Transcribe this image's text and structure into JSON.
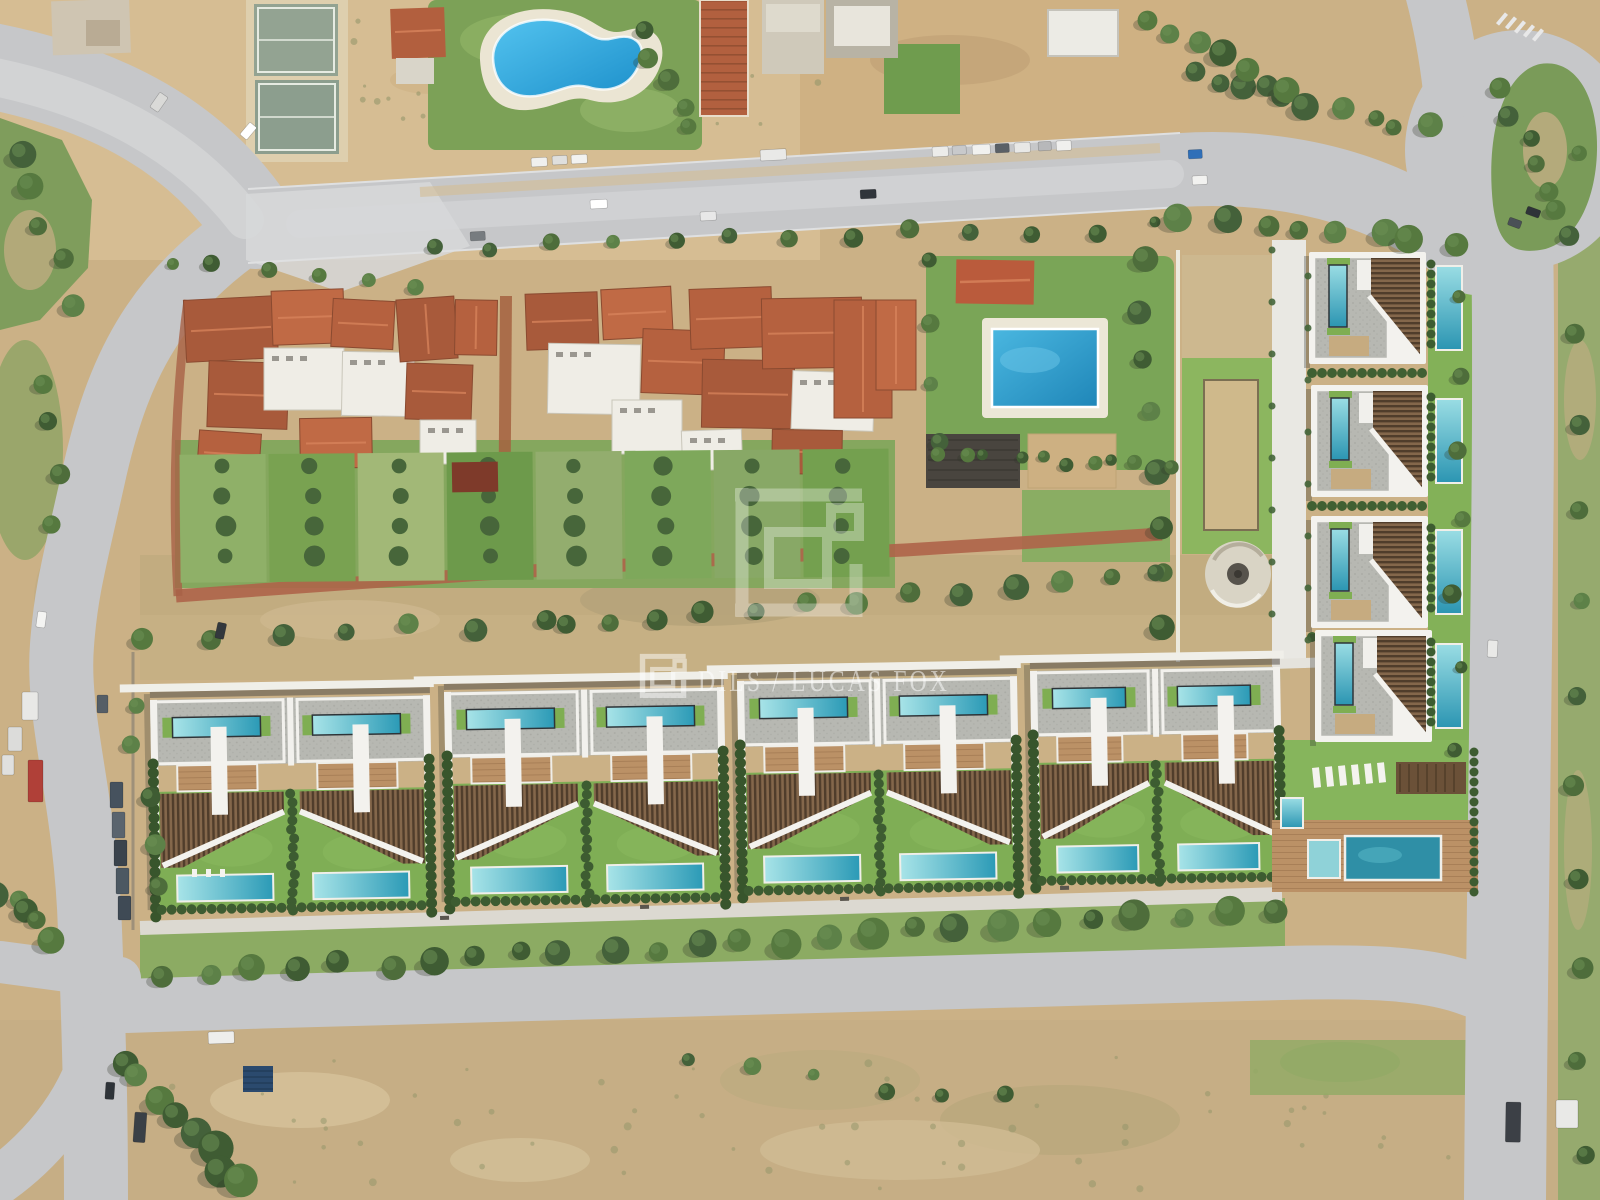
{
  "meta": {
    "title": "Aerial drone photograph of a modern villa development beside an established Mediterranean neighbourhood",
    "image_type": "aerial-photograph",
    "view": "top-down"
  },
  "watermark": {
    "logo_icon": "dils-bracket-logo",
    "text": "DILS / LUCAS FOX",
    "color": "#ffffff",
    "text_opacity": 0.52,
    "big_logo_opacity": 0.32,
    "small_logo_opacity": 0.5
  },
  "palette": {
    "dirt": "#cbb186",
    "dirt_light": "#d6bd93",
    "dirt_dark": "#b5a176",
    "road": "#c6c7c9",
    "road_light": "#d4d5d6",
    "concrete": "#d8d9da",
    "grass": "#7da45a",
    "grass_bright": "#7fae55",
    "grass_pale": "#9ab173",
    "tree": "#4e6d3b",
    "hedge": "#3d5c31",
    "terracotta": "#b5613f",
    "white_roof": "#efede6",
    "gray_roof": "#b6b7b1",
    "wood_deck": "#c9ad83",
    "louver": "#84674b",
    "louver_dark": "#503d2b",
    "pool_blue": "#2fa3d8",
    "pool_teal": "#2b9ab6",
    "pool_teal_light": "#a8e4e8",
    "brick_path": "#ae6449",
    "white_wall": "#f3f2ee"
  },
  "development": {
    "bottom_blocks": [
      {
        "x": 150,
        "y": 700,
        "w": 280
      },
      {
        "x": 444,
        "y": 692,
        "w": 280
      },
      {
        "x": 737,
        "y": 681,
        "w": 280
      },
      {
        "x": 1030,
        "y": 671,
        "w": 250
      }
    ],
    "right_villas": [
      {
        "x": 1309,
        "y": 252
      },
      {
        "x": 1311,
        "y": 385
      },
      {
        "x": 1311,
        "y": 516
      },
      {
        "x": 1315,
        "y": 630
      }
    ],
    "villa_size": {
      "w": 117,
      "h": 112
    },
    "ground_pool_x": 1436,
    "pool_loungers": [
      {
        "x": 192,
        "y": 869
      },
      {
        "x": 206,
        "y": 869
      },
      {
        "x": 220,
        "y": 869
      }
    ],
    "amenity_loungers": [
      {
        "x": 1312,
        "y": 768
      },
      {
        "x": 1325,
        "y": 767
      },
      {
        "x": 1338,
        "y": 766
      },
      {
        "x": 1351,
        "y": 765
      },
      {
        "x": 1364,
        "y": 764
      },
      {
        "x": 1377,
        "y": 763
      }
    ],
    "bench_positions": [
      [
        440,
        916
      ],
      [
        640,
        905
      ],
      [
        840,
        897
      ],
      [
        1060,
        886
      ]
    ]
  },
  "cluster_roofs": [
    [
      185,
      298,
      92,
      62,
      -3,
      "t"
    ],
    [
      208,
      362,
      80,
      66,
      2,
      "t"
    ],
    [
      272,
      290,
      72,
      54,
      -2,
      "t"
    ],
    [
      264,
      348,
      80,
      62,
      0,
      "w"
    ],
    [
      332,
      300,
      62,
      48,
      3,
      "t"
    ],
    [
      342,
      352,
      72,
      64,
      1,
      "w"
    ],
    [
      300,
      418,
      72,
      50,
      -1,
      "t"
    ],
    [
      198,
      432,
      62,
      44,
      4,
      "t"
    ],
    [
      398,
      298,
      58,
      62,
      -4,
      "t"
    ],
    [
      406,
      364,
      66,
      56,
      2,
      "t"
    ],
    [
      420,
      420,
      56,
      44,
      0,
      "w"
    ],
    [
      455,
      300,
      42,
      55,
      1,
      "t"
    ],
    [
      526,
      293,
      72,
      56,
      -2,
      "t"
    ],
    [
      548,
      344,
      92,
      70,
      1,
      "w"
    ],
    [
      602,
      288,
      70,
      50,
      -3,
      "t"
    ],
    [
      642,
      330,
      82,
      64,
      2,
      "t"
    ],
    [
      612,
      400,
      70,
      54,
      0,
      "w"
    ],
    [
      690,
      288,
      82,
      60,
      -2,
      "t"
    ],
    [
      702,
      360,
      92,
      68,
      1,
      "t"
    ],
    [
      762,
      298,
      100,
      70,
      -1,
      "t"
    ],
    [
      792,
      372,
      82,
      58,
      2,
      "w"
    ],
    [
      834,
      300,
      58,
      118,
      0,
      "t"
    ],
    [
      772,
      430,
      70,
      44,
      1,
      "t"
    ],
    [
      682,
      430,
      60,
      40,
      -2,
      "w"
    ],
    [
      876,
      300,
      40,
      90,
      0,
      "t"
    ]
  ],
  "garden_plots": {
    "x1": 180,
    "w": 86,
    "gap": 3,
    "y": 452,
    "h": 128,
    "count": 8,
    "colors": [
      "#8fb068",
      "#79a251",
      "#a2b877",
      "#6d9a4b",
      "#93ad6e",
      "#7ea85b",
      "#88a866",
      "#74a04f"
    ],
    "tree_columns": [
      224,
      312,
      400,
      488,
      576,
      664,
      752,
      840
    ]
  },
  "tree_rows": [
    [
      430,
      252,
      1150,
      226,
      13,
      5,
      10
    ],
    [
      1185,
      218,
      1455,
      240,
      8,
      9,
      15
    ],
    [
      1190,
      70,
      1430,
      130,
      9,
      8,
      14
    ],
    [
      150,
      640,
      545,
      622,
      7,
      6,
      12
    ],
    [
      560,
      622,
      1160,
      574,
      13,
      7,
      14
    ],
    [
      168,
      975,
      1268,
      912,
      26,
      9,
      16
    ],
    [
      690,
      1065,
      1010,
      1100,
      6,
      5,
      9
    ],
    [
      1452,
      300,
      1462,
      745,
      7,
      6,
      10
    ],
    [
      1572,
      150,
      1578,
      1150,
      12,
      7,
      12
    ],
    [
      638,
      35,
      692,
      128,
      5,
      7,
      11
    ],
    [
      1155,
      18,
      1310,
      105,
      8,
      9,
      15
    ],
    [
      15,
      150,
      75,
      300,
      5,
      9,
      14
    ],
    [
      120,
      1060,
      245,
      1185,
      8,
      11,
      18
    ],
    [
      42,
      380,
      58,
      520,
      4,
      8,
      12
    ],
    [
      165,
      262,
      420,
      285,
      6,
      5,
      9
    ],
    [
      935,
      262,
      940,
      445,
      4,
      7,
      10
    ],
    [
      1145,
      255,
      1160,
      630,
      8,
      8,
      13
    ],
    [
      133,
      700,
      152,
      888,
      5,
      7,
      11
    ],
    [
      940,
      458,
      1165,
      462,
      10,
      5,
      8
    ],
    [
      0,
      895,
      55,
      935,
      5,
      9,
      14
    ],
    [
      1500,
      90,
      1560,
      210,
      6,
      8,
      13
    ]
  ],
  "vehicles": {
    "parked_top_row": [
      {
        "x": 531,
        "y": 158,
        "w": 16,
        "h": 9,
        "c": "#f0f0ee"
      },
      {
        "x": 552,
        "y": 156,
        "w": 15,
        "h": 9,
        "c": "#dfdfdd"
      },
      {
        "x": 571,
        "y": 155,
        "w": 16,
        "h": 9,
        "c": "#f2f2f0"
      },
      {
        "x": 760,
        "y": 150,
        "w": 26,
        "h": 11,
        "c": "#e9e9e7"
      },
      {
        "x": 932,
        "y": 147,
        "w": 16,
        "h": 10,
        "c": "#ececea"
      },
      {
        "x": 952,
        "y": 146,
        "w": 14,
        "h": 9,
        "c": "#c8c9cb"
      },
      {
        "x": 972,
        "y": 145,
        "w": 18,
        "h": 10,
        "c": "#f1f1ef"
      },
      {
        "x": 995,
        "y": 144,
        "w": 14,
        "h": 9,
        "c": "#5a6066"
      },
      {
        "x": 1014,
        "y": 143,
        "w": 16,
        "h": 10,
        "c": "#e8e8e6"
      },
      {
        "x": 1038,
        "y": 142,
        "w": 13,
        "h": 9,
        "c": "#b7b8ba"
      },
      {
        "x": 1056,
        "y": 141,
        "w": 15,
        "h": 10,
        "c": "#f0f0ee"
      },
      {
        "x": 1188,
        "y": 150,
        "w": 14,
        "h": 9,
        "c": "#2f6fb8"
      }
    ],
    "parked_left": [
      {
        "x": 22,
        "y": 692,
        "w": 16,
        "h": 28,
        "c": "#e8e8e6"
      },
      {
        "x": 8,
        "y": 727,
        "w": 14,
        "h": 24,
        "c": "#dcdcda"
      },
      {
        "x": 2,
        "y": 755,
        "w": 12,
        "h": 20,
        "c": "#e0e0de"
      },
      {
        "x": 28,
        "y": 760,
        "w": 15,
        "h": 42,
        "c": "#b04038"
      },
      {
        "x": 97,
        "y": 695,
        "w": 11,
        "h": 18,
        "c": "#555e66"
      },
      {
        "x": 110,
        "y": 782,
        "w": 13,
        "h": 26,
        "c": "#46525e"
      },
      {
        "x": 112,
        "y": 812,
        "w": 13,
        "h": 26,
        "c": "#5a646e"
      },
      {
        "x": 114,
        "y": 840,
        "w": 13,
        "h": 26,
        "c": "#3a434c"
      },
      {
        "x": 116,
        "y": 868,
        "w": 13,
        "h": 26,
        "c": "#4c5862"
      },
      {
        "x": 118,
        "y": 896,
        "w": 13,
        "h": 24,
        "c": "#3f4a55"
      }
    ],
    "on_road": [
      {
        "x": 590,
        "y": 200,
        "w": 17,
        "h": 9,
        "c": "#ffffff",
        "r": -3
      },
      {
        "x": 700,
        "y": 212,
        "w": 16,
        "h": 9,
        "c": "#e8e8e8",
        "r": -3
      },
      {
        "x": 860,
        "y": 190,
        "w": 16,
        "h": 9,
        "c": "#30353b",
        "r": -3
      },
      {
        "x": 470,
        "y": 232,
        "w": 15,
        "h": 9,
        "c": "#777c80",
        "r": -3
      },
      {
        "x": 1192,
        "y": 176,
        "w": 15,
        "h": 9,
        "c": "#f2f2f0",
        "r": -3
      },
      {
        "x": 1528,
        "y": 206,
        "w": 14,
        "h": 8,
        "c": "#2e3338",
        "r": 20
      },
      {
        "x": 1510,
        "y": 217,
        "w": 13,
        "h": 8,
        "c": "#4a5056",
        "r": 20
      },
      {
        "x": 38,
        "y": 611,
        "w": 9,
        "h": 16,
        "c": "#f4f4f2",
        "r": 8
      },
      {
        "x": 160,
        "y": 92,
        "w": 10,
        "h": 18,
        "c": "#dadad8",
        "r": 35
      },
      {
        "x": 250,
        "y": 122,
        "w": 9,
        "h": 16,
        "c": "#ffffff",
        "r": 40
      },
      {
        "x": 106,
        "y": 1082,
        "w": 9,
        "h": 17,
        "c": "#2e3338",
        "r": 4
      },
      {
        "x": 135,
        "y": 1112,
        "w": 12,
        "h": 30,
        "c": "#3a4046",
        "r": 4
      },
      {
        "x": 208,
        "y": 1032,
        "w": 26,
        "h": 12,
        "c": "#eeeeec",
        "r": -2
      },
      {
        "x": 218,
        "y": 622,
        "w": 9,
        "h": 16,
        "c": "#33383d",
        "r": 12
      },
      {
        "x": 1506,
        "y": 1102,
        "w": 15,
        "h": 40,
        "c": "#3c4046",
        "r": 1
      },
      {
        "x": 1556,
        "y": 1100,
        "w": 22,
        "h": 28,
        "c": "#e9e9e7",
        "r": 0
      },
      {
        "x": 1488,
        "y": 640,
        "w": 10,
        "h": 17,
        "c": "#e9e9e7",
        "r": 3
      }
    ],
    "solar_carport": {
      "x": 243,
      "y": 1066,
      "w": 30,
      "h": 26,
      "c": "#2b4a6e"
    }
  }
}
